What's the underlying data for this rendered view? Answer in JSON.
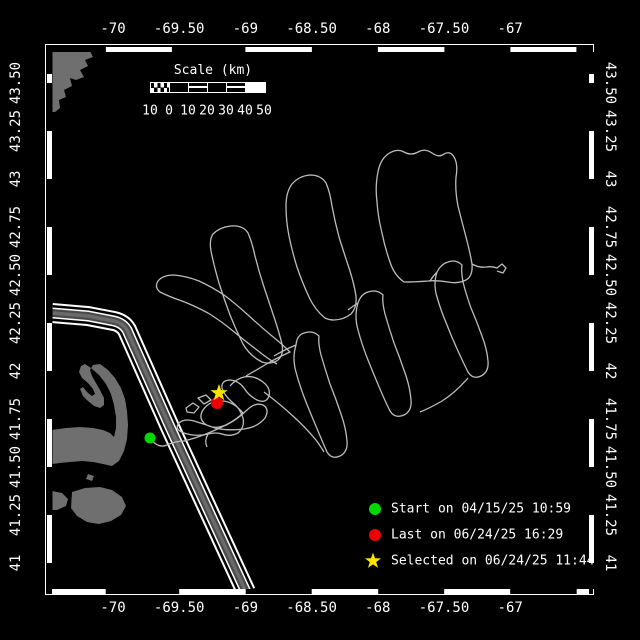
{
  "figure": {
    "type": "track-map",
    "region": "Gulf of Maine / Cape Cod",
    "background": "#000000"
  },
  "axes": {
    "top_labels": [
      "-70",
      "-69.50",
      "-69",
      "-68.50",
      "-68",
      "-67.50",
      "-67"
    ],
    "bottom_labels": [
      "-70",
      "-69.50",
      "-69",
      "-68.50",
      "-68",
      "-67.50",
      "-67"
    ],
    "left_labels": [
      "43.50",
      "43.25",
      "43",
      "42.75",
      "42.50",
      "42.25",
      "42",
      "41.75",
      "41.50",
      "41.25",
      "41"
    ],
    "right_labels": [
      "43.50",
      "43.25",
      "43",
      "42.75",
      "42.50",
      "42.25",
      "42",
      "41.75",
      "41.50",
      "41.25",
      "41"
    ]
  },
  "scale_bar": {
    "title": "Scale (km)",
    "labels": [
      "10",
      "0",
      "10",
      "20",
      "30",
      "40",
      "50"
    ]
  },
  "legend": {
    "entries": [
      {
        "marker": "circle",
        "color": "#00d800",
        "label": "Start on 04/15/25 10:59"
      },
      {
        "marker": "circle",
        "color": "#ee0000",
        "label": "Last on 06/24/25 16:29"
      },
      {
        "marker": "star",
        "color": "#ffe400",
        "label": "Selected on 06/24/25 11:44"
      }
    ]
  },
  "colors": {
    "frame": "#ffffff",
    "text": "#ffffff",
    "land": "#6f6f6f",
    "track": "#bcbcbc",
    "lane_dark": "#4a4a4a",
    "lane_light": "#6a6a6a",
    "start": "#00d800",
    "last": "#ee0000",
    "selected": "#ffe400"
  },
  "map": {
    "land": [
      "M52,51 L90,51 L93,57 L85,60 L88,66 L80,70 L84,77 L76,80 L70,78 L72,86 L64,90 L66,97 L59,100 L60,108 L55,112 L52,112 Z",
      "M52,430 L66,428 L80,427 L93,428 L103,430 L110,433 L114,437 L116,428 L116,417 L114,405 L111,394 L106,384 L99,375 L91,368 L85,364 L81,366 L79,372 L82,378 L88,383 L93,389 L95,394 L92,396 L87,392 L83,387 L80,389 L83,396 L88,401 L94,406 L100,408 L104,405 L104,398 L100,390 L96,383 L92,376 L90,370 L93,365 L100,364 L108,370 L115,378 L121,388 L125,399 L127,411 L128,425 L127,439 L124,451 L119,461 L112,466 L103,464 L93,462 L82,461 L70,462 L60,463 L52,464 Z",
      "M72,492 L85,488 L100,487 L112,490 L122,497 L126,506 L121,515 L111,521 L99,524 L87,522 L77,516 L71,508 Z",
      "M52,491 L62,493 L68,499 L66,506 L57,510 L52,510 Z",
      "M88,474 L94,476 L92,481 L86,479 Z"
    ],
    "lane": {
      "d": "M52,313 L88,316 L114,321 Q123,323 127,330 L170,427 L246,592",
      "layers": [
        {
          "color": "#ffffff",
          "width": 20
        },
        {
          "color": "#000000",
          "width": 16
        },
        {
          "color": "#ffffff",
          "width": 11
        },
        {
          "color": "#4a4a4a",
          "width": 8
        },
        {
          "color": "#6a6a6a",
          "width": 3.5
        }
      ]
    },
    "tracks": [
      "M150,438 Q158,449 167,445 Q176,441 184,441 Q196,438 206,434 Q216,430 226,425 Q236,420 243,413",
      "M243,413 Q234,402 223,401 Q210,400 203,410 Q198,418 205,424 Q214,430 226,425 Q238,419 247,410 Q255,402 263,405 Q270,409 265,418 Q258,427 244,429 Q228,431 215,428 Q204,424 194,421 Q183,418 178,424 Q175,430 184,433 Q196,437 208,434 Q216,432 222,434 Q230,437 238,433 Q245,427 243,418 Q240,408 232,402 Q224,395 222,388 Q221,381 229,380 Q238,380 244,388 Q249,396 257,400 Q266,404 269,396 Q271,388 263,382 Q254,375 244,377 Q236,379 230,386",
      "M186,408 L193,403 L199,407 L194,413 L187,412 Z",
      "M198,398 L206,395 L211,400 L204,404 Z",
      "M208,434 Q204,441 207,447",
      "M246,376 Q258,369 270,362 Q281,356 290,352 Q282,344 272,336 Q260,326 248,315 Q236,304 224,295 Q212,287 199,281 Q186,276 174,275 Q163,275 158,281 Q154,287 160,292 Q170,297 182,301 Q195,306 208,313 Q221,321 233,331 Q245,341 257,350 Q268,359 277,364",
      "M262,362 Q250,356 243,344 Q236,330 230,315 Q224,299 219,283 Q214,266 211,251 Q209,240 213,234 Q220,227 231,226 Q243,225 248,233 Q252,242 255,256 Q259,272 264,287 Q269,302 274,317 Q279,332 282,344 Q284,355 278,360 Q271,365 262,362 Z",
      "M274,356 Q286,349 296,345",
      "M296,345 Q292,358 296,372 Q300,387 306,402 Q312,417 318,431 Q323,443 327,452 Q332,460 340,456 Q348,452 347,441 Q346,428 341,414 Q336,399 330,384 Q325,369 321,355 Q318,343 319,336 Q313,330 304,333 Q297,335 296,345 Z",
      "M264,392 Q280,404 294,417 Q306,428 316,440 Q321,447 324,452",
      "M325,318 Q315,310 309,297 Q302,282 297,267 Q292,251 289,236 Q286,221 286,206 Q286,192 292,184 Q299,176 310,175 Q321,175 326,183 Q330,192 332,206 Q335,222 339,237 Q344,253 349,268 Q354,283 356,296 Q357,308 351,314 Q343,320 334,320 Q329,320 325,318 Z",
      "M348,310 Q353,306 358,303",
      "M358,303 Q354,316 358,330 Q362,345 368,360 Q374,375 380,389 Q385,401 390,411 Q395,419 404,415 Q412,411 411,400 Q410,387 405,373 Q400,358 394,343 Q389,328 385,314 Q382,302 383,295 Q377,289 368,292 Q361,294 358,303 Z",
      "M404,282 Q394,275 390,262 Q385,248 382,233 Q378,217 377,202 Q375,186 378,172 Q380,160 388,154 Q397,148 404,152 Q411,156 418,152 Q425,148 432,153 Q439,158 444,154 Q451,150 455,159 Q458,166 456,177 Q455,191 458,206 Q462,222 466,237 Q470,252 472,264 Q473,276 466,280 Q458,284 448,282 Q437,280 428,281 Q415,282 404,282 Z",
      "M430,281 Q433,276 437,272",
      "M472,264 Q479,268 486,267 Q492,266 497,268 L502,264 L506,268 L503,273 L497,271",
      "M437,272 Q433,284 437,297 Q441,311 447,325 Q452,338 458,351 Q463,362 468,372 Q473,380 481,376 Q489,372 488,361 Q487,349 482,336 Q477,322 471,308 Q466,294 463,282 Q461,271 462,265 Q456,259 448,262 Q441,264 437,272 Z",
      "M468,378 Q455,393 442,401 Q430,408 420,412"
    ],
    "markers": [
      {
        "name": "start-marker",
        "type": "circle",
        "x": 150,
        "y": 438,
        "r": 5.5,
        "color": "#00d800"
      },
      {
        "name": "last-marker",
        "type": "circle",
        "x": 217,
        "y": 403,
        "r": 6,
        "color": "#ee0000"
      },
      {
        "name": "selected-marker",
        "type": "star",
        "x": 219,
        "y": 393,
        "r": 9,
        "color": "#ffe400"
      }
    ]
  }
}
